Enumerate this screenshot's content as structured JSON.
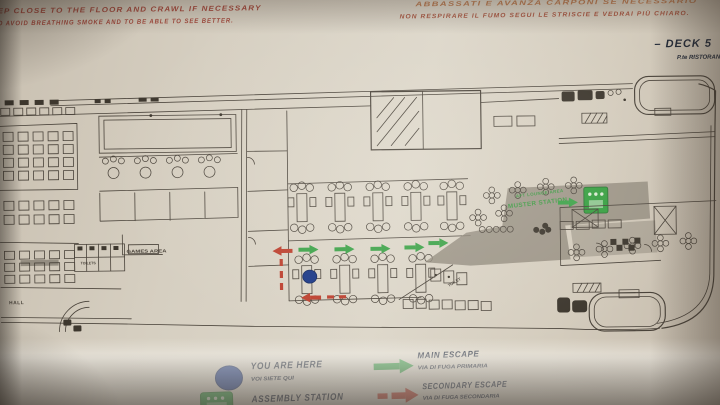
{
  "instructions": {
    "english": [
      "EP CLOSE TO THE FLOOR AND CRAWL IF NECESSARY",
      "O AVOID BREATHING SMOKE AND TO BE ABLE TO SEE BETTER."
    ],
    "italian": [
      "ABBASSATI E AVANZA CARPONI SE NECESSARIO",
      "NON RESPIRARE IL FUMO SEGUI LE STRISCIE E VEDRAI PIÙ CHIARO."
    ]
  },
  "deck": {
    "name": "– DECK 5",
    "sub": "P.te RISTORAN"
  },
  "plan": {
    "labels": {
      "hall": "HALL",
      "toilets": "TOILETS",
      "toilet": "TOILET",
      "games_area": "GAMES AREA",
      "muster_line1": "AFT LOUNGE AREA",
      "muster_line2": "MUSTER STATION"
    },
    "markers": {
      "you_are_here_icon": "blue-dot",
      "assembly_icon": "green-assembly-square",
      "main_escape_icon": "green-arrow-right",
      "secondary_escape_icon": "red-dashed-arrow-left"
    }
  },
  "legend": {
    "you_are_here": {
      "label": "YOU ARE HERE",
      "sublabel": "VOI SIETE QUI",
      "icon": "blue-dot",
      "color": "#1c3a8c"
    },
    "assembly_station": {
      "label": "ASSEMBLY STATION",
      "icon": "assembly-station-symbol",
      "color": "#2f9e3f"
    },
    "main_escape": {
      "label": "MAIN ESCAPE",
      "sublabel": "VIA DI FUGA PRIMARIA",
      "icon": "green-arrow-right",
      "color": "#2f9e3f"
    },
    "secondary_escape": {
      "label": "SECONDARY ESCAPE",
      "sublabel": "VIA DI FUGA SECONDARIA",
      "icon": "red-dash-arrow-right",
      "color": "#c2402e"
    }
  },
  "colors": {
    "ink": "#4a433a",
    "paper": "#d6cfc1",
    "red_text": "#a8493c",
    "orange_text": "#bd7a4e",
    "navy_text": "#232b3a",
    "escape_green": "#3aa447",
    "escape_red": "#c2402e",
    "muster_gray": "#8f887a",
    "you_are_here_blue": "#1c3a8c",
    "assembly_green": "#33a13e"
  }
}
